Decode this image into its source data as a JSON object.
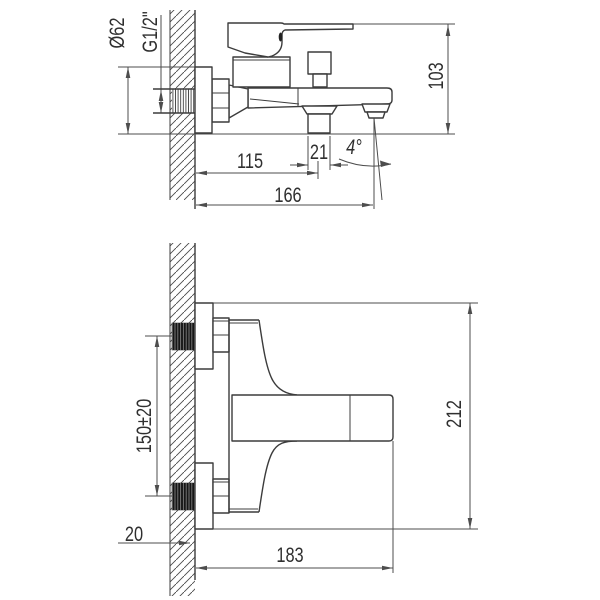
{
  "side_view": {
    "escutcheon_diameter": "Ø62",
    "thread_size": "G1/2\"",
    "body_height": "103",
    "shower_outlet_offset": "115",
    "outlet_width": "21",
    "spout_angle": "4°",
    "spout_reach": "166"
  },
  "plan_view": {
    "inlet_spacing": "150±20",
    "overall_span": "212",
    "wall_thickness": "20",
    "projection": "183"
  },
  "colors": {
    "outline": "#3c3c3c",
    "dimension": "#4d4d4d",
    "label": "#2f2f2f",
    "background": "#ffffff"
  }
}
